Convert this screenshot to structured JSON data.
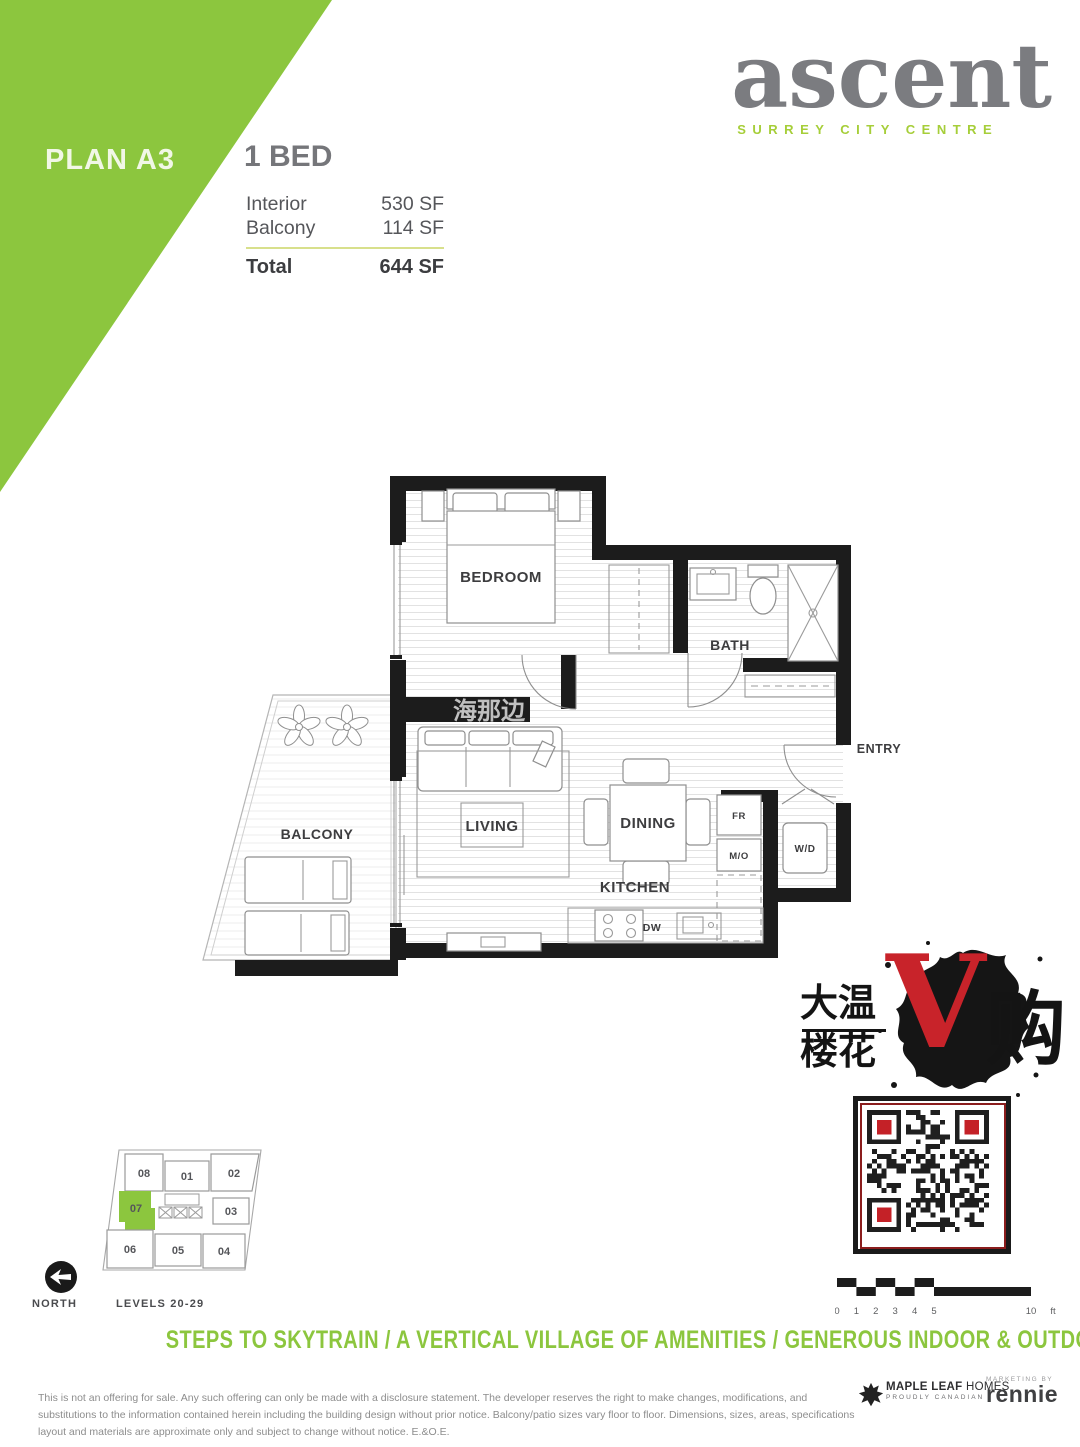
{
  "header": {
    "plan_label": "PLAN A3",
    "bed_label": "1 BED",
    "areas": [
      {
        "label": "Interior",
        "value": "530 SF"
      },
      {
        "label": "Balcony",
        "value": "114 SF"
      }
    ],
    "total_label": "Total",
    "total_value": "644 SF"
  },
  "brand": {
    "name": "ascent",
    "tagline": "SURREY CITY CENTRE"
  },
  "floorplan": {
    "rooms": {
      "bedroom": "BEDROOM",
      "bath": "BATH",
      "entry": "ENTRY",
      "living": "LIVING",
      "dining": "DINING",
      "kitchen": "KITCHEN",
      "balcony": "BALCONY"
    },
    "appliances": {
      "fridge": "FR",
      "microwave": "M/O",
      "washer_dryer": "W/D",
      "dishwasher": "DW"
    },
    "watermark": "海那边"
  },
  "keyplan": {
    "units": [
      "08",
      "01",
      "02",
      "07",
      "03",
      "06",
      "05",
      "04"
    ],
    "highlighted_unit": "07",
    "north_label": "NORTH",
    "levels_label": "LEVELS 20-29"
  },
  "scalebar": {
    "ticks": [
      "0",
      "1",
      "2",
      "3",
      "4",
      "5",
      "10"
    ],
    "unit": "ft"
  },
  "stamp": {
    "left_top": "大温",
    "left_bottom": "楼花",
    "v": "V",
    "right": "购"
  },
  "footer": {
    "tagline": "STEPS TO SKYTRAIN  /  A VERTICAL VILLAGE OF AMENITIES  /  GENEROUS INDOOR & OUTDOOR LAYOUTS  /  A TRUSTED DEVELOPER",
    "disclaimer": "This is not an offering for sale. Any such offering can only be made with a disclosure statement. The developer reserves the right to make changes, modifications, and substitutions to the information contained herein including the building design without prior notice. Balcony/patio sizes vary floor to floor. Dimensions, sizes, areas, specifications layout and materials are approximate only and subject to change without notice. E.&O.E.",
    "developer_bold": "MAPLE LEAF",
    "developer_light": " HOMES",
    "developer_sub": "PROUDLY CANADIAN",
    "marketing_by": "MARKETING BY",
    "marketing_name": "rennie"
  },
  "colors": {
    "green": "#8CC63E",
    "light_green": "#A6CE39",
    "gray": "#77787B",
    "red": "#C42127",
    "wall_black": "#1C1C1C"
  }
}
